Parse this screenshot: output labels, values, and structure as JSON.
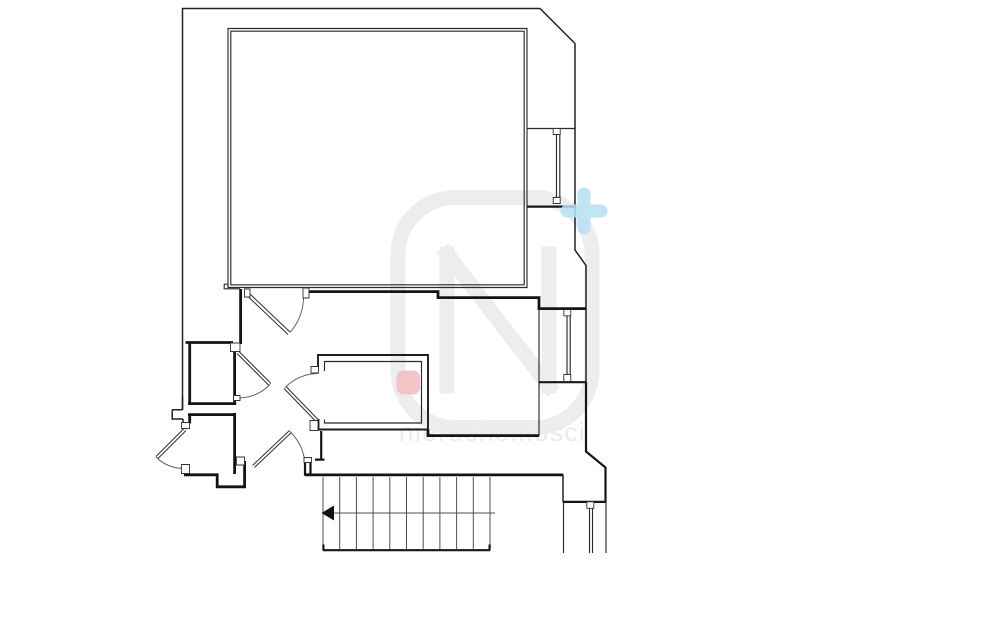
{
  "colors": {
    "background": "#ffffff",
    "line": "#1c1c1c",
    "watermark": "#ededed",
    "watermark_text": "#ebebeb",
    "plus_marker": "#b5e0f3",
    "pink_marker": "#f3bfc2",
    "arrow": "#111111"
  },
  "watermark": {
    "logo_letter_path": "M447,254 V386 M447,254 L549,386 M549,254 V386",
    "frame_path": "M455,197.5 h80 a57,57 0 0 1 57,57 v116 a57,57 0 0 1 -57,57 h-80 a57,57 0 0 1 -57,-57 v-116 a57,57 0 0 1 57,-57 z",
    "text": "nieruchomości"
  },
  "plan": {
    "paths": {
      "outer_top_left": "M182.5,410 V8.5 H540 L575,43.5 V206",
      "outer_mid_right": "M575,206 V250 L586,265.5 V382",
      "right_outer_lower": "M586,382 V451.5 L605.5,467.5 V501.5",
      "notch": "M182.5,396 V409.8 M172.2,409.8 H182.5 M172.2,409.8 V419 H183 M183,419 V423",
      "room_top_outer": "M228,28.5 H527 V287.5 H228 Z",
      "room_top_inner": "M230.8,31.2 H524.2 V284.8 H230.8 Z",
      "room_top_corner_step": "M228,284.2 L224.2,284.2 V288.8 L240,288.8",
      "bay1_top": "M527,128.5 H575",
      "bay1_bottom": "M527,206.6 H575",
      "bay1_glass": "M556.5,131 V202 M559.8,131 V202",
      "bay2_left": "M539,308 V436",
      "bay2_bottom": "M538.5,382.2 H586.5",
      "bay2_glass": "M567,312 V378 M570.2,312 V378",
      "bay3_top": "M562.5,501.9 H606.5",
      "bay3_left_upper": "M563,474.5 V501",
      "bay3_sides": "M563.5,502 V553 M606,502 V553",
      "bay3_glass": "M589.5,508 V553 M592.5,508 V553",
      "glass_tick_1a": "M553.2,128.5 h7 v6 h-7 z",
      "glass_tick_1b": "M553.2,197.5 h7 v6 h-7 z",
      "glass_tick_2a": "M563.8,308.8 h7 v7 h-7 z",
      "glass_tick_2b": "M563.8,374.5 h7 v7 h-7 z",
      "glass_tick_3a": "M586.8,501.8 h7 v6.5 h-7 z",
      "corridor_top_wall": "M304,291.6 H438 V297.6 H539 V308.6 H586",
      "hall_left_wall_upper": "M240.6,289 V344",
      "room_upper_left": "M185.5,342.5 H233 M189.7,342.5 V403.5 M234.6,351.5 V403.5 M188,403.6 H236.2",
      "room_lower_left": "M188,414.6 H236 M189.7,414.6 V423.5 M234.6,413 V474 M184,474.8 H217.2 V486.8 H244.6 V461",
      "middle_room_outer": "M318,372.5 V355 H428 V429.5 H318.5 V419",
      "middle_room_inner": "M324.5,371 V361.5 H421.5 V423 H324.5 V419.5",
      "below_middle_wall": "M428,429.5 V435.6 H539",
      "corridor_left_stub": "M321.2,431 V459 M315,459.6 H324.5",
      "stair_top_wall": "M305,474.9 H563",
      "post_d": "M305,458.5 h5.5 v16 h-5.5 z",
      "leaf_a": "M250,294 L290,332 M248,296.5 L288,334.5",
      "leaf_b": "M239,351.5 L271,383.5 M237,353.5 L269,385.5",
      "leaf_c": "M318,419.5 L286,386.5 M316,421.5 L284,388.5",
      "leaf_d": "M252.5,465.5 L289.5,430.5 M254.4,467.5 L291.4,432.5",
      "leaf_e": "M184,428.5 L156,456.5 M186,430.5 L158,458.5",
      "arc_a": "M290,332.5 A54,54 0 0 0 303.5,294.5",
      "arc_b": "M270,384.5 A45,45 0 0 1 239.5,398",
      "arc_c": "M285,387.5 A47,47 0 0 1 317.5,373.5",
      "arc_d": "M290,431.5 A51,51 0 0 1 304.5,459",
      "arc_e": "M156,457 A40,40 0 0 0 183.5,468.5",
      "jamb_a1": "M244.5,289 h5.5 v8 h-5.5 z",
      "jamb_a2": "M303,288 h6 v10 h-6 z",
      "jamb_b1": "M230.5,343 h9.5 v8.5 h-9.5 z",
      "jamb_b2": "M233.5,395.5 h6.5 v5 h-6.5 z",
      "jamb_c1": "M311,366.5 h7.5 v6.5 h-7.5 z",
      "jamb_c2": "M310,420.5 h8 v10 h-8 z",
      "jamb_d1": "M236.5,457 h8 v8 h-8 z",
      "jamb_d2": "M304,457.5 h7.5 v5 h-7.5 z",
      "jamb_e1": "M181.5,422.5 h8 v6 h-8 z",
      "jamb_e2": "M181.5,464.5 h8 v9 h-8 z",
      "stairs_treads": "M323,477 V549 M339.7,477 V549 M356.4,477 V549 M373.1,477 V549 M389.8,477 V549 M406.5,477 V549 M423.2,477 V549 M439.9,477 V549 M456.6,477 V549 M473.3,477 V549 M490,477 V549",
      "stairs_direction_line": "M327,513 H495",
      "stairs_arrow": "M321.5,513 L334,505.5 L334,520.5 Z",
      "stairs_bottom_edge": "M322.8,550.2 H490.2 M323.4,550 V544.5 M489.6,550 V544.5"
    }
  },
  "markers": {
    "plus_path": "M584,194 V228 M567,211 H601",
    "pink": {
      "x": "396.5",
      "y": "370.5",
      "width": "23.5",
      "height": "24",
      "rx": "7"
    }
  }
}
